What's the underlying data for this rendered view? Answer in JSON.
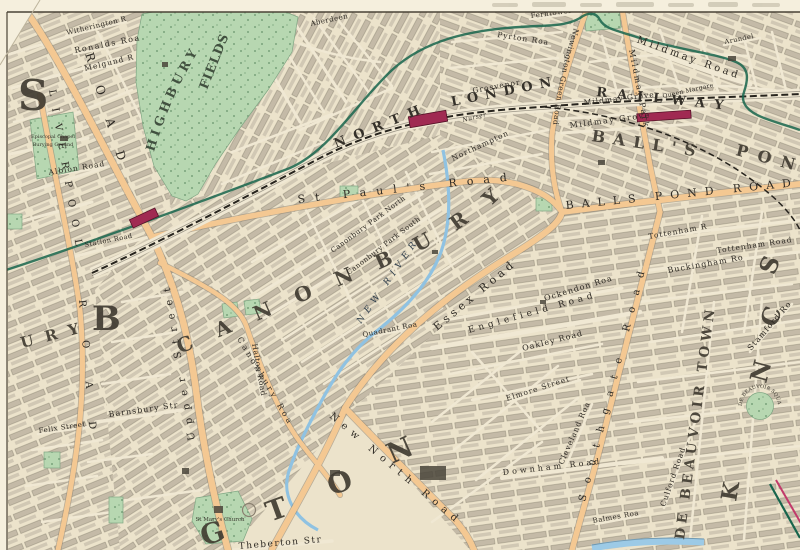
{
  "colors": {
    "paper": "#ece3cb",
    "margin": "#f5efdd",
    "street": "#f0e8d3",
    "block_row": "#9b9284",
    "road_fill": "#f4c892",
    "road_casing": "#8a8070",
    "park": "#b7d7b1",
    "park_dot": "#66936a",
    "railway_ink": "#26231d",
    "boundary_green": "#17654c",
    "boundary_pink": "#c13a6a",
    "station": "#a02a52",
    "river": "#8fc2e2",
    "canal": "#9ccae6",
    "ink": "#33302a"
  },
  "districts": {
    "canonbury": "CANONBURY",
    "balls": "BALL'S",
    "pond": "PON",
    "de_beauvoir_town": "DE BEAUVOIR TOWN",
    "islington_letters": [
      "G",
      "T",
      "O",
      "N"
    ],
    "barnsbury_b": "B",
    "barnsbury_ury": "URY",
    "big_s": "S",
    "edge_letters": [
      "S",
      "C",
      "N",
      "K"
    ]
  },
  "railway": {
    "north": "NORTH",
    "london": "LONDON",
    "railway": "RAILWAY"
  },
  "parks": {
    "highbury": "HIGHBURY",
    "fields": "FIELDS",
    "chapel_line1": "Episcopal Chapel",
    "chapel_line2": "Burying Ground"
  },
  "water": {
    "new_river": "NEW RIVER"
  },
  "places": {
    "de_beauvoir_square": "DE BEAUVOIR SQUARE",
    "st_marys_church": "St Mary's Church"
  },
  "roads": [
    {
      "text": "Mildmay Road"
    },
    {
      "text": "Mildmay Grove"
    },
    {
      "text": "Mildmay Grove"
    },
    {
      "text": "Mildmay Park"
    },
    {
      "text": "Newington Green Road"
    },
    {
      "text": "St Paul's Road"
    },
    {
      "text": "BALLS POND ROAD"
    },
    {
      "text": "Southgate Road"
    },
    {
      "text": "Essex Road"
    },
    {
      "text": "New North Road"
    },
    {
      "text": "Canonbury Road"
    },
    {
      "text": "Upper Street"
    },
    {
      "text": "LIVERPOOL"
    },
    {
      "text": "ROAD"
    },
    {
      "text": "ROAD"
    },
    {
      "text": "Englefield Road"
    },
    {
      "text": "Ockendon Road"
    },
    {
      "text": "Oakley Road"
    },
    {
      "text": "Tottenham Road"
    },
    {
      "text": "Tottenham Road"
    },
    {
      "text": "Buckingham Road"
    },
    {
      "text": "Stamford Road"
    },
    {
      "text": "Culford Road"
    },
    {
      "text": "Halton Road"
    },
    {
      "text": "Barnsbury Street"
    },
    {
      "text": "Theberton Street"
    },
    {
      "text": "Felix Street"
    },
    {
      "text": "Albion Road"
    },
    {
      "text": "Ronalds Road"
    },
    {
      "text": "Melgund Rd"
    },
    {
      "text": "Witherington Rd"
    },
    {
      "text": "Aberdeen Park"
    },
    {
      "text": "Grosvenor Road"
    },
    {
      "text": "Pyrton Road"
    },
    {
      "text": "Ferntower Rd"
    },
    {
      "text": "Northampton Park"
    },
    {
      "text": "Canonbury Park North"
    },
    {
      "text": "Canonbury Park South"
    },
    {
      "text": "Quadrant Road"
    },
    {
      "text": "Elmore Street"
    },
    {
      "text": "Cleveland Road"
    },
    {
      "text": "Downham Road"
    },
    {
      "text": "Balmes Road"
    },
    {
      "text": "Arundel St."
    },
    {
      "text": "Queen Margaret's Gr."
    },
    {
      "text": "Nursery"
    },
    {
      "text": "Station Road"
    }
  ]
}
